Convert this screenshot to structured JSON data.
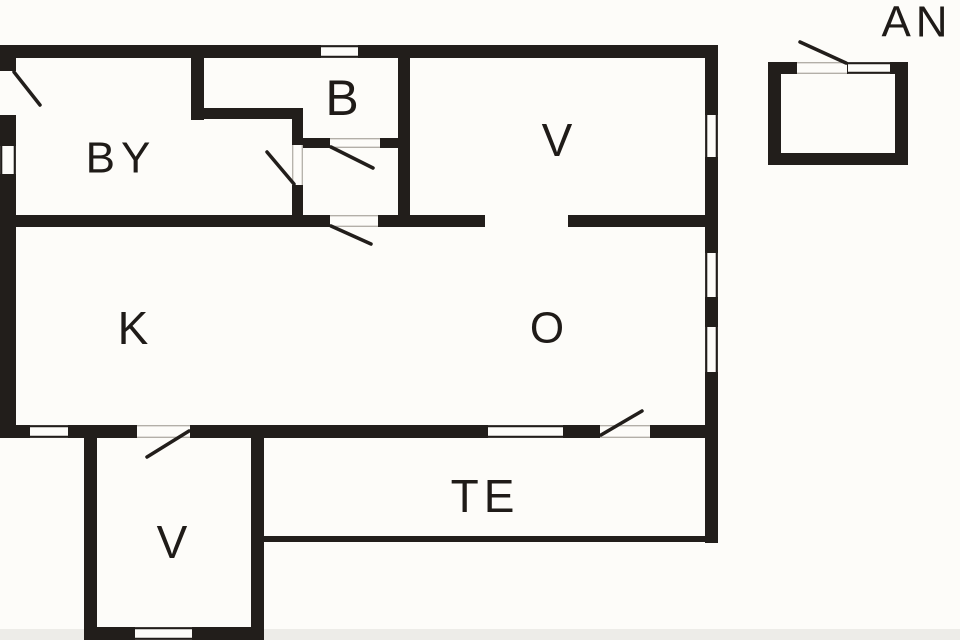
{
  "figure": {
    "kind": "floor-plan"
  },
  "rooms": {
    "by": {
      "label": "BY"
    },
    "b": {
      "label": "B"
    },
    "v_top": {
      "label": "V"
    },
    "k": {
      "label": "K"
    },
    "o": {
      "label": "O"
    },
    "te": {
      "label": "TE"
    },
    "v_bottom": {
      "label": "V"
    },
    "an": {
      "label": "AN"
    }
  },
  "colors": {
    "wall": "#221e1b",
    "background": "#fdfcf9",
    "label": "#1f1b18",
    "threshold_line": "#b3afa8",
    "scan_strip": "#edece8"
  }
}
